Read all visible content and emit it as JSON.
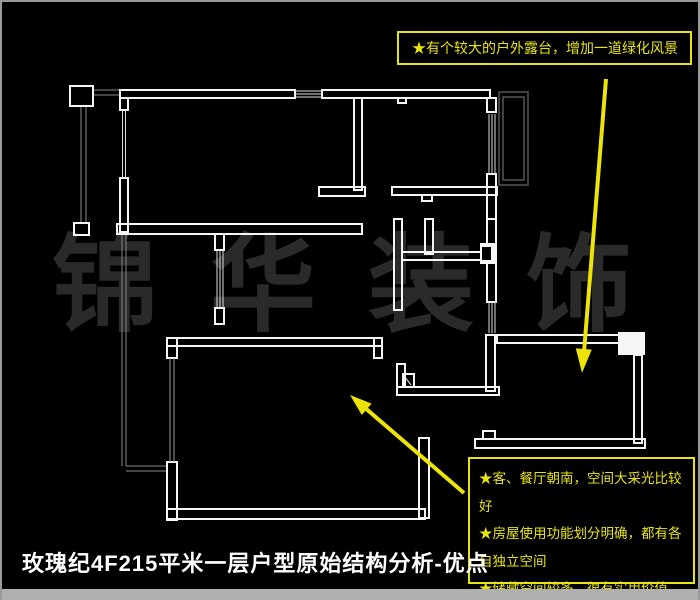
{
  "page": {
    "title": "玫瑰纪4F215平米一层户型原始结构分析-优点",
    "watermark": "锦华装饰"
  },
  "annotations": {
    "top_note": "★有个较大的户外露台，增加一道绿化风景",
    "bottom_notes": [
      "★客、餐厅朝南，空间大采光比较好",
      "★房屋使用功能划分明确，都有各自独立空间",
      "★储藏空间较多，很有实用价值"
    ]
  },
  "colors": {
    "background": "#000000",
    "wall_line": "#f5f5f5",
    "window_line": "#dddddd",
    "balcony_thin_line": "#888888",
    "right_balcony_line": "#555555",
    "annotation_yellow": "#e8e410",
    "arrow_yellow": "#ece408",
    "watermark_gray": "#2a2a2a",
    "title_white": "#ffffff",
    "frame_gray": "#9a9a9a"
  }
}
